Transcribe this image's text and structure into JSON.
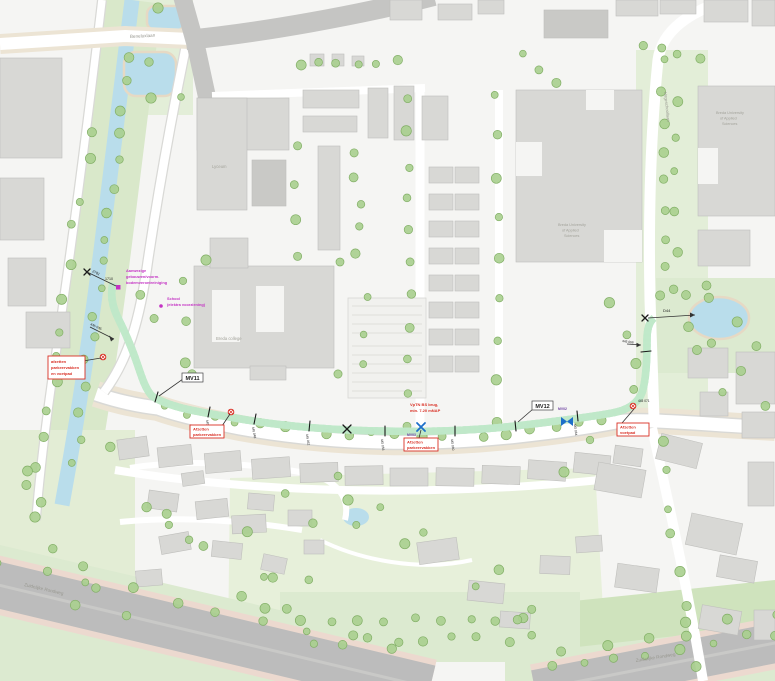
{
  "map": {
    "colors": {
      "background": "#f5f5f3",
      "building": "#d8d8d5",
      "building_dark": "#c9c9c6",
      "water": "#b9ddeb",
      "green_area": "#e2eed4",
      "green_bank": "#d9e8ca",
      "tree_fill": "#a8cf8e",
      "tree_stroke": "#82af66",
      "road_white": "#ffffff",
      "road_major": "#c5c5c3",
      "highway": "#bcbcbc",
      "verge_tan": "#ece4d4",
      "route_green": "#1fae3d",
      "route_blue": "#2e9fd4",
      "annotation_red": "#d93025",
      "annotation_magenta": "#c433c4",
      "marker_blue": "#1d6fc9"
    },
    "streets": {
      "top_road": "Beneluxlaan",
      "right_street": "Hogeschoollaan",
      "highway_left": "Zuidelijke Rondweg",
      "highway_right": "Zuidelijke Rondweg"
    },
    "buildings": {
      "lyceum": "Lyceum",
      "college": "Breda college",
      "university_lines": [
        "Breda University",
        "of Applied",
        "Sciences"
      ],
      "campus_lines": [
        "Breda University",
        "of Applied",
        "Sciences"
      ]
    },
    "route": {
      "start_chainage": "2781",
      "start_point": "1710",
      "end_label": "D44",
      "chainage_canal": "445 045",
      "chainage_ticks": [
        "445 046",
        "445 048",
        "445 052",
        "445 056",
        "445 060",
        "445 064"
      ],
      "chainage_north": "445 068",
      "chainage_end": "445 071",
      "valves": {
        "mv11": "MV11",
        "mv12": "MV12",
        "mv02": "MV02",
        "mv03": "MV03"
      }
    },
    "annotations": {
      "soil_note_lines": [
        "Aanwezige",
        "gebouwen/voorm.",
        "bodemverontreiniging"
      ],
      "school_note_lines": [
        "School",
        "(elektra voorziening)"
      ],
      "bridge_note_lines": [
        "VpTN BS brug,",
        "min. 7.20 mNAP"
      ],
      "closure_left_lines": [
        "afzetten",
        "parkeervakken",
        "en voetpad"
      ],
      "closure_mid_left_lines": [
        "Afzetten",
        "parkeervakken"
      ],
      "closure_mid_lines": [
        "Afzetten",
        "parkeervakken"
      ],
      "closure_right_lines": [
        "Afzetten",
        "voetpad"
      ]
    }
  }
}
